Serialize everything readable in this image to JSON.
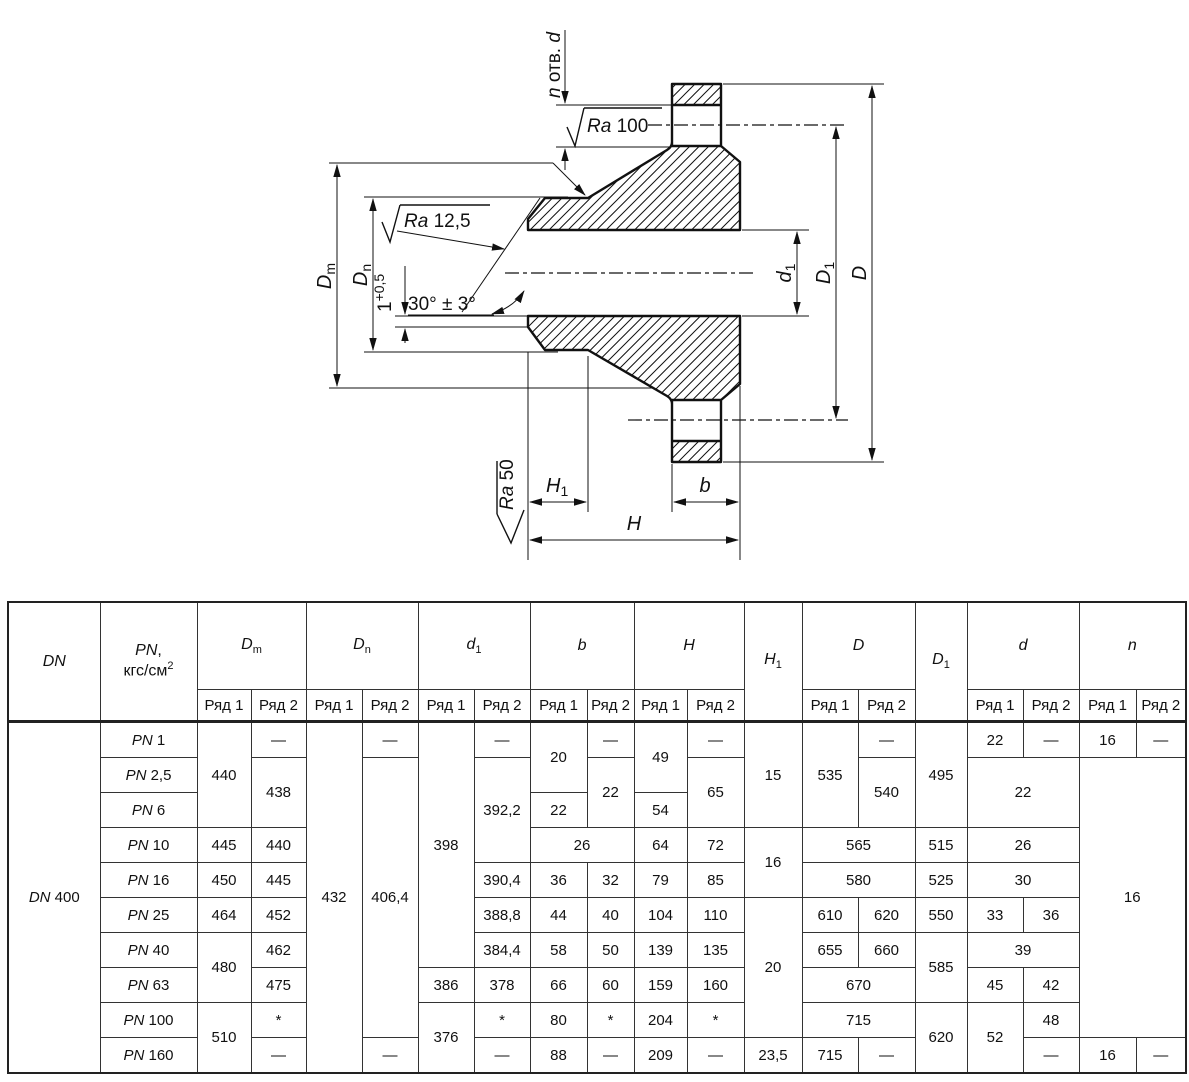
{
  "drawing": {
    "n_holes_n": "n",
    "n_holes_mid": " отв. ",
    "n_holes_d": "d",
    "ra100_ra": "Ra",
    "ra100_val": " 100",
    "ra125_ra": "Ra",
    "ra125_val": " 12,5",
    "ra50_ra": "Ra",
    "ra50_val": " 50",
    "angle": "30° ± 3°",
    "chamfer_base": "1",
    "chamfer_sup": "+0,5",
    "dm_main": "D",
    "dm_sub": "m",
    "dn_main": "D",
    "dn_sub": "n",
    "d1s_main": "d",
    "d1s_sub": "1",
    "d1b_main": "D",
    "d1b_sub": "1",
    "d_label": "D",
    "h_label": "H",
    "h1_main": "H",
    "h1_sub": "1",
    "b_label": "b"
  },
  "table": {
    "head_row1": [
      {
        "it": "DN",
        "rs": 2
      },
      {
        "it": "PN",
        "post": ",",
        "line2": "кгс/см",
        "line2sup": "2",
        "rs": 2
      },
      {
        "it": "D",
        "sub": "m",
        "cs": 2
      },
      {
        "it": "D",
        "sub": "n",
        "cs": 2
      },
      {
        "it": "d",
        "sub": "1",
        "cs": 2
      },
      {
        "it": "b",
        "cs": 2
      },
      {
        "it": "H",
        "cs": 2
      },
      {
        "it": "H",
        "sub": "1",
        "rs": 2
      },
      {
        "it": "D",
        "cs": 2
      },
      {
        "it": "D",
        "sub": "1",
        "rs": 2
      },
      {
        "it": "d",
        "cs": 2
      },
      {
        "it": "n",
        "cs": 2
      }
    ],
    "head_row2": [
      "Ряд 1",
      "Ряд 2",
      "Ряд 1",
      "Ряд 2",
      "Ряд 1",
      "Ряд 2",
      "Ряд 1",
      "Ряд 2",
      "Ряд 1",
      "Ряд 2",
      "Ряд 1",
      "Ряд 2",
      "Ряд 1",
      "Ряд 2",
      "Ряд 1",
      "Ряд 2"
    ],
    "body": [
      [
        {
          "pre": "DN",
          "t": "400",
          "rs": 10
        },
        {
          "pre": "PN",
          "t": "1"
        },
        {
          "t": "440",
          "rs": 3
        },
        {
          "t": "—"
        },
        {
          "t": "432",
          "rs": 10
        },
        {
          "t": "—"
        },
        {
          "t": "398",
          "rs": 7
        },
        {
          "t": "—"
        },
        {
          "t": "20",
          "rs": 2
        },
        {
          "t": "—"
        },
        {
          "t": "49",
          "rs": 2
        },
        {
          "t": "—"
        },
        {
          "t": "15",
          "rs": 3
        },
        {
          "t": "535",
          "rs": 3
        },
        {
          "t": "—"
        },
        {
          "t": "495",
          "rs": 3
        },
        {
          "t": "22"
        },
        {
          "t": "—"
        },
        {
          "t": "16"
        },
        {
          "t": "—"
        }
      ],
      [
        {
          "pre": "PN",
          "t": "2,5"
        },
        {
          "t": "438",
          "rs": 2
        },
        {
          "t": "406,4",
          "rs": 8
        },
        {
          "t": "392,2",
          "rs": 3
        },
        {
          "t": "22",
          "rs": 2
        },
        {
          "t": "65",
          "rs": 2
        },
        {
          "t": "540",
          "rs": 2
        },
        {
          "t": "22",
          "rs": 2,
          "cs": 2
        },
        {
          "t": "16",
          "rs": 8,
          "cs": 2
        }
      ],
      [
        {
          "pre": "PN",
          "t": "6"
        },
        {
          "t": "22"
        },
        {
          "t": "54"
        }
      ],
      [
        {
          "pre": "PN",
          "t": "10"
        },
        {
          "t": "445"
        },
        {
          "t": "440"
        },
        {
          "t": "26",
          "cs": 2
        },
        {
          "t": "64"
        },
        {
          "t": "72"
        },
        {
          "t": "16",
          "rs": 2
        },
        {
          "t": "565",
          "cs": 2
        },
        {
          "t": "515"
        },
        {
          "t": "26",
          "cs": 2
        }
      ],
      [
        {
          "pre": "PN",
          "t": "16"
        },
        {
          "t": "450"
        },
        {
          "t": "445"
        },
        {
          "t": "390,4"
        },
        {
          "t": "36"
        },
        {
          "t": "32"
        },
        {
          "t": "79"
        },
        {
          "t": "85"
        },
        {
          "t": "580",
          "cs": 2
        },
        {
          "t": "525"
        },
        {
          "t": "30",
          "cs": 2
        }
      ],
      [
        {
          "pre": "PN",
          "t": "25"
        },
        {
          "t": "464"
        },
        {
          "t": "452"
        },
        {
          "t": "388,8"
        },
        {
          "t": "44"
        },
        {
          "t": "40"
        },
        {
          "t": "104"
        },
        {
          "t": "110"
        },
        {
          "t": "20",
          "rs": 4
        },
        {
          "t": "610"
        },
        {
          "t": "620"
        },
        {
          "t": "550"
        },
        {
          "t": "33"
        },
        {
          "t": "36"
        }
      ],
      [
        {
          "pre": "PN",
          "t": "40"
        },
        {
          "t": "480",
          "rs": 2
        },
        {
          "t": "462"
        },
        {
          "t": "384,4"
        },
        {
          "t": "58"
        },
        {
          "t": "50"
        },
        {
          "t": "139"
        },
        {
          "t": "135"
        },
        {
          "t": "655"
        },
        {
          "t": "660"
        },
        {
          "t": "585",
          "rs": 2
        },
        {
          "t": "39",
          "cs": 2
        }
      ],
      [
        {
          "pre": "PN",
          "t": "63"
        },
        {
          "t": "475"
        },
        {
          "t": "386"
        },
        {
          "t": "378"
        },
        {
          "t": "66"
        },
        {
          "t": "60"
        },
        {
          "t": "159"
        },
        {
          "t": "160"
        },
        {
          "t": "670",
          "cs": 2
        },
        {
          "t": "45"
        },
        {
          "t": "42"
        }
      ],
      [
        {
          "pre": "PN",
          "t": "100"
        },
        {
          "t": "510",
          "rs": 2
        },
        {
          "t": "*"
        },
        {
          "t": "376",
          "rs": 2
        },
        {
          "t": "*"
        },
        {
          "t": "80"
        },
        {
          "t": "*"
        },
        {
          "t": "204"
        },
        {
          "t": "*"
        },
        {
          "t": "715",
          "cs": 2
        },
        {
          "t": "620",
          "rs": 2
        },
        {
          "t": "52",
          "rs": 2
        },
        {
          "t": "48"
        }
      ],
      [
        {
          "pre": "PN",
          "t": "160"
        },
        {
          "t": "—"
        },
        {
          "t": "—"
        },
        {
          "t": "—"
        },
        {
          "t": "88"
        },
        {
          "t": "—"
        },
        {
          "t": "209"
        },
        {
          "t": "—"
        },
        {
          "t": "23,5"
        },
        {
          "t": "715"
        },
        {
          "t": "—"
        },
        {
          "t": "—"
        },
        {
          "t": "16"
        },
        {
          "t": "—"
        }
      ]
    ]
  }
}
